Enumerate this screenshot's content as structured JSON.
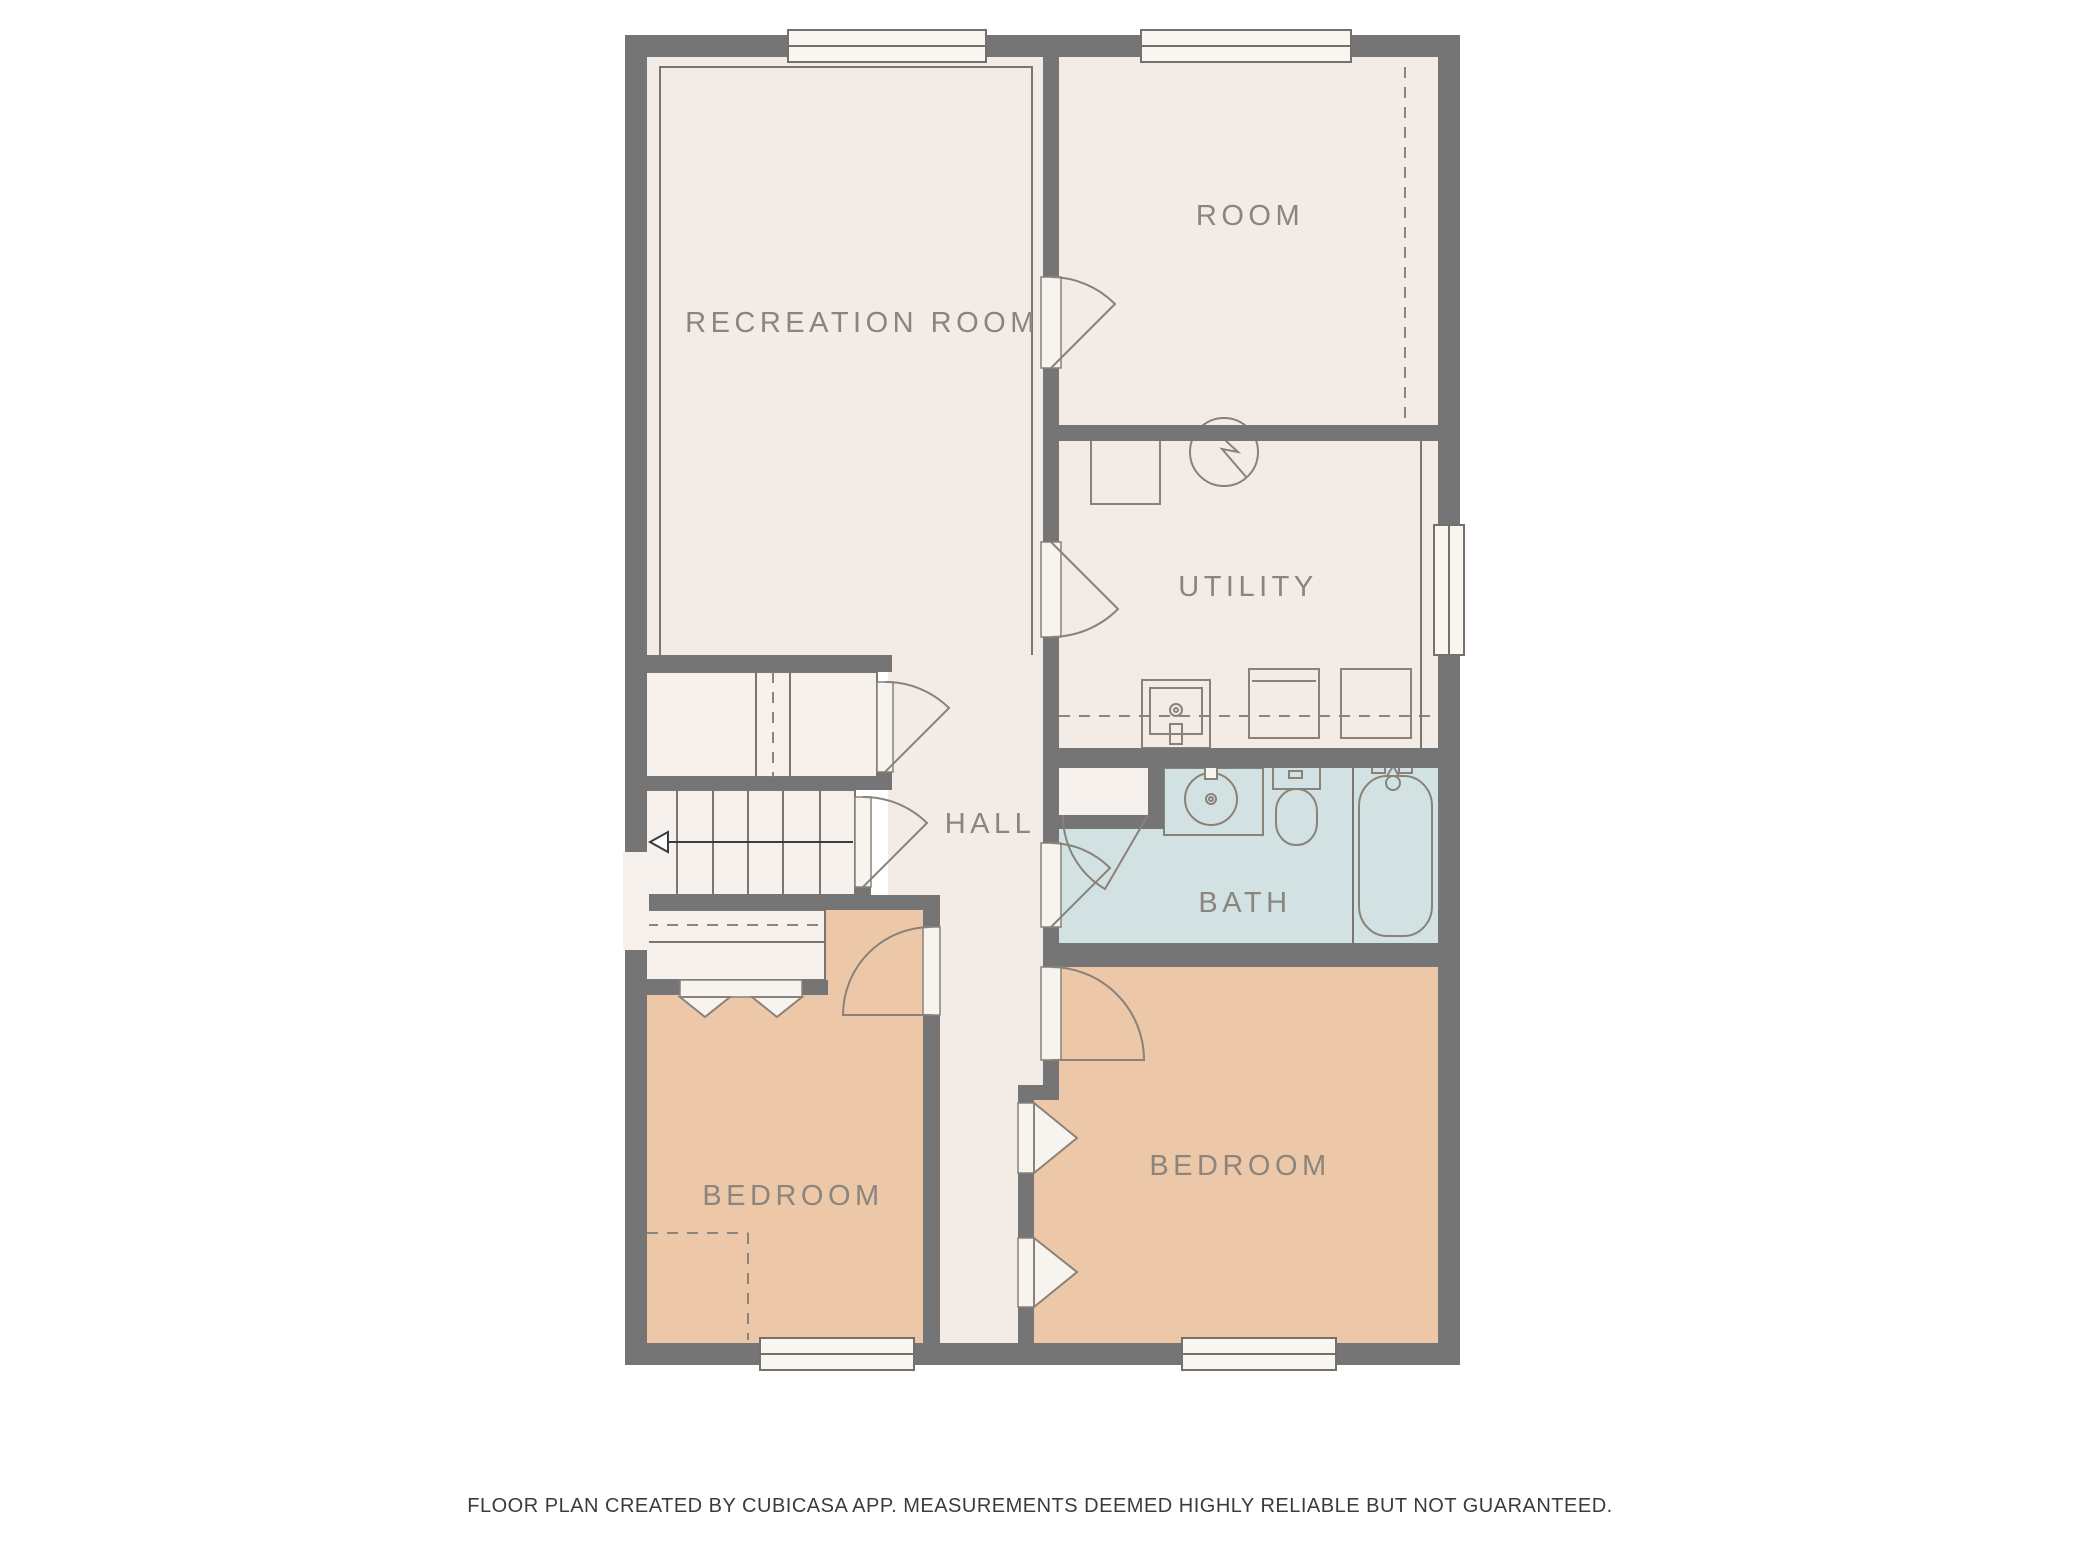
{
  "title": "Floor plan",
  "rooms": [
    {
      "name": "recreation-room",
      "label": "RECREATION ROOM"
    },
    {
      "name": "room",
      "label": "ROOM"
    },
    {
      "name": "utility",
      "label": "UTILITY"
    },
    {
      "name": "hall",
      "label": "HALL"
    },
    {
      "name": "bath",
      "label": "BATH"
    },
    {
      "name": "bedroom-left",
      "label": "BEDROOM"
    },
    {
      "name": "bedroom-right",
      "label": "BEDROOM"
    }
  ],
  "fixtures": [
    "staircase",
    "stair-direction-arrow",
    "hall-closet",
    "under-stair-closet",
    "bedroom-bifold-closet",
    "hall-bifold-closet",
    "fan-symbol",
    "water-heater",
    "utility-sink",
    "washer",
    "dryer",
    "bathroom-sink",
    "toilet",
    "bathtub",
    "doors",
    "windows"
  ],
  "colors": {
    "wall": "#757575",
    "floor": "#f3ebe5",
    "bedroom_floor": "#ecc8a9",
    "bath_floor": "#d2e2e2",
    "fixture_line": "#8a8279",
    "label_text": "#8b857e"
  },
  "footer": {
    "disclaimer": "FLOOR PLAN CREATED BY CUBICASA APP. MEASUREMENTS DEEMED HIGHLY RELIABLE BUT NOT GUARANTEED."
  }
}
